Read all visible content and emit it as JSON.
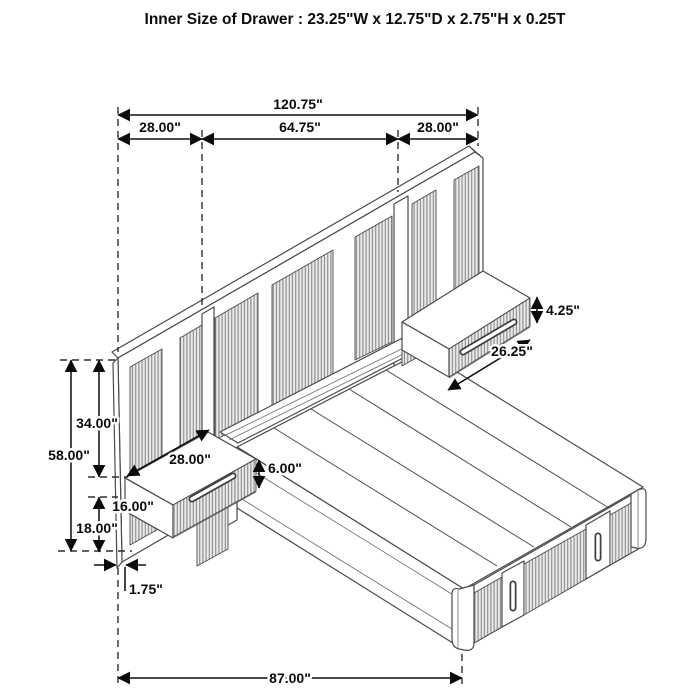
{
  "title": "Inner Size of Drawer : 23.25\"W x 12.75\"D x 2.75\"H x 0.25T",
  "dims": {
    "total_width": "120.75\"",
    "left_section_width": "28.00\"",
    "center_section_width": "64.75\"",
    "right_section_width": "28.00\"",
    "headboard_total_height": "58.00\"",
    "headboard_upper_height": "34.00\"",
    "left_nightstand_width": "28.00\"",
    "left_nightstand_front_height": "6.00\"",
    "mount_gap_height": "16.00\"",
    "under_nightstand_height": "18.00\"",
    "panel_thickness": "1.75\"",
    "bed_base_length": "87.00\"",
    "right_nightstand_front_height": "4.25\"",
    "right_nightstand_width": "26.25\""
  }
}
